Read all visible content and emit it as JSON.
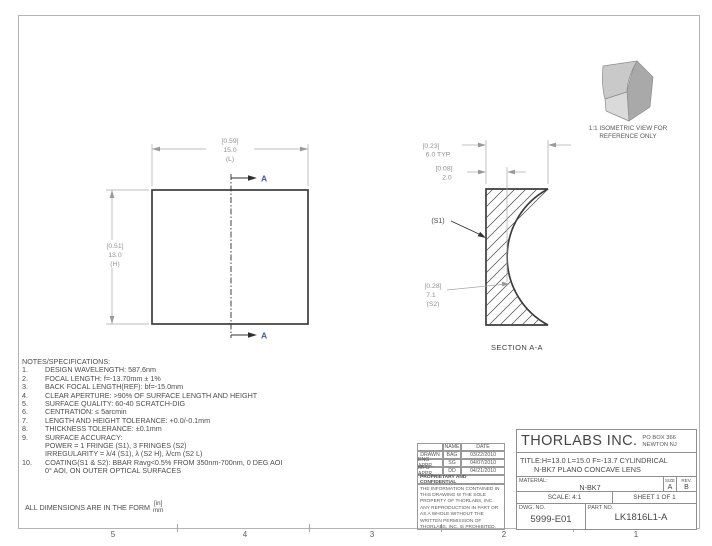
{
  "grid_labels": [
    "5",
    "4",
    "3",
    "2",
    "1"
  ],
  "front_view": {
    "width_dim": {
      "inches": "[0.59]",
      "mm": "15.0",
      "label": "(L)"
    },
    "height_dim": {
      "inches": "[0.51]",
      "mm": "13.0",
      "label": "(H)"
    },
    "section_arrow_label_top": "A",
    "section_arrow_label_bottom": "A"
  },
  "section_view": {
    "title": "SECTION A-A",
    "edge_thickness_dim": {
      "inches": "[0.23]",
      "mm": "6.0 TYP"
    },
    "center_thickness_dim": {
      "inches": "[0.08]",
      "mm": "2.0"
    },
    "surface1_label": "(S1)",
    "radius_dim": {
      "inches": "[0.28]",
      "mm": "7.1",
      "label": "(S2)"
    }
  },
  "isometric": {
    "caption_line1": "1:1 ISOMETRIC VIEW FOR",
    "caption_line2": "REFERENCE ONLY"
  },
  "notes": {
    "title": "NOTES/SPECIFICATIONS:",
    "items": [
      {
        "num": "1.",
        "text": "DESIGN WAVELENGTH: 587.6nm"
      },
      {
        "num": "2.",
        "text": "FOCAL LENGTH: f=-13.70mm ± 1%"
      },
      {
        "num": "3.",
        "text": "BACK FOCAL LENGTH(REF): bf=-15.0mm"
      },
      {
        "num": "4.",
        "text": "CLEAR APERTURE: >90% OF SURFACE LENGTH AND HEIGHT"
      },
      {
        "num": "5.",
        "text": "SURFACE QUALITY: 60-40 SCRATCH-DIG"
      },
      {
        "num": "6.",
        "text": "CENTRATION: ≤ 5arcmin"
      },
      {
        "num": "7.",
        "text": "LENGTH AND HEIGHT TOLERANCE: +0.0/-0.1mm"
      },
      {
        "num": "8.",
        "text": "THICKNESS TOLERANCE: ±0.1mm"
      },
      {
        "num": "9.",
        "text": "SURFACE ACCURACY:"
      },
      {
        "num": "",
        "text": "POWER = 1 FRINGE (S1), 3 FRINGES (S2)"
      },
      {
        "num": "",
        "text": "IRREGULARITY = λ/4 (S1), λ (S2 H), λ/cm (S2 L)"
      },
      {
        "num": "10.",
        "text": "COATING(S1 & S2): BBAR Ravg<0.5% FROM 350nm-700nm, 0 DEG AOI"
      },
      {
        "num": "",
        "text": "0° AOI, ON OUTER OPTICAL SURFACES"
      }
    ]
  },
  "dimensions_form": {
    "prefix": "ALL DIMENSIONS ARE IN THE FORM",
    "numerator": "[in]",
    "denominator": "mm"
  },
  "title_block": {
    "company": "THORLABS INC.",
    "address_line1": "PO BOX 366",
    "address_line2": "NEWTON NJ",
    "title_line1": "TITLE:H=13.0 L=15.0 F=-13.7 CYLINDRICAL",
    "title_line2": "N-BK7 PLANO CONCAVE LENS",
    "material_label": "MATERIAL:",
    "material": "N-BK7",
    "size_label": "SIZE",
    "size": "A",
    "rev_label": "REV.",
    "rev": "B",
    "scale": "SCALE: 4:1",
    "sheet": "SHEET 1 OF 1",
    "dwg_label": "DWG.  NO.",
    "dwg_no": "5999-E01",
    "part_label": "PART  NO.",
    "part_no": "LK1816L1-A",
    "approvals": {
      "name_header": "NAME",
      "date_header": "DATE",
      "rows": [
        {
          "role": "DRAWN",
          "name": "BAG",
          "date": "03/22/2010"
        },
        {
          "role": "ENG APPR.",
          "name": "SG",
          "date": "04/07/2010"
        },
        {
          "role": "MFG APPR.",
          "name": "DD",
          "date": "04/21/2010"
        }
      ]
    },
    "proprietary_header": "PROPRIETARY AND CONFIDENTIAL",
    "proprietary_body": "THE INFORMATION CONTAINED IN THIS DRAWING IS THE SOLE PROPERTY OF THORLABS, INC.  ANY REPRODUCTION IN PART OR AS A WHOLE WITHOUT THE WRITTEN PERMISSION OF THORLABS, INC. IS PROHIBITED."
  }
}
